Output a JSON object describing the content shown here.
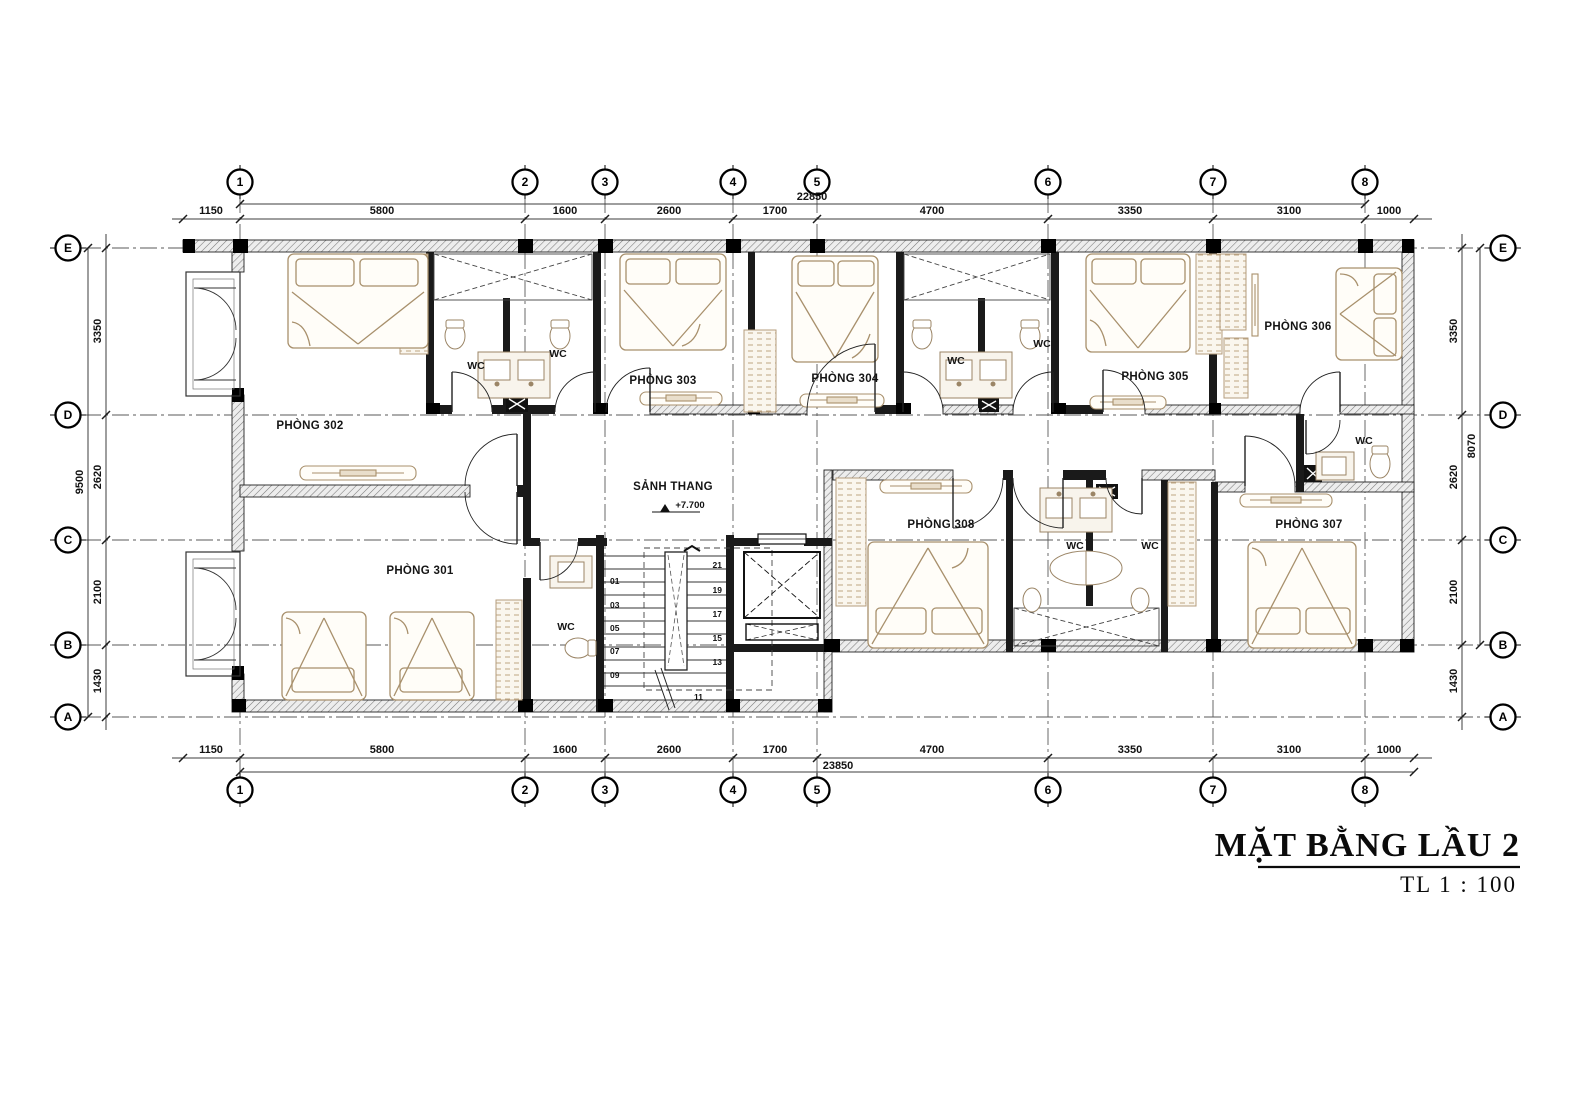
{
  "drawing": {
    "title": "MẶT BẰNG LẦU 2",
    "scale": "TL  1 : 100"
  },
  "grid": {
    "cols": [
      "1",
      "2",
      "3",
      "4",
      "5",
      "6",
      "7",
      "8"
    ],
    "rows": [
      "E",
      "D",
      "C",
      "B",
      "A"
    ]
  },
  "dims": {
    "top": {
      "segs": [
        "1150",
        "5800",
        "1600",
        "2600",
        "1700",
        "4700",
        "3350",
        "3100",
        "1000"
      ],
      "total": "22850"
    },
    "bottom": {
      "segs": [
        "1150",
        "5800",
        "1600",
        "2600",
        "1700",
        "4700",
        "3350",
        "3100",
        "1000"
      ],
      "total": "23850"
    },
    "left": {
      "segs": [
        "3350",
        "2620",
        "2100",
        "1430"
      ],
      "total": "9500"
    },
    "right": {
      "segs": [
        "3350",
        "2620",
        "2100",
        "1430"
      ],
      "total": "8070"
    }
  },
  "labels": {
    "r301": "PHÒNG 301",
    "r302": "PHÒNG 302",
    "r303": "PHÒNG 303",
    "r304": "PHÒNG 304",
    "r305": "PHÒNG 305",
    "r306": "PHÒNG 306",
    "r307": "PHÒNG 307",
    "r308": "PHÒNG 308",
    "lobby": "SẢNH THANG",
    "level": "+7.700",
    "wc": "WC"
  },
  "stair": {
    "left": [
      "01",
      "03",
      "05",
      "07",
      "09"
    ],
    "right": [
      "21",
      "19",
      "17",
      "15",
      "13"
    ],
    "mid": "11"
  }
}
